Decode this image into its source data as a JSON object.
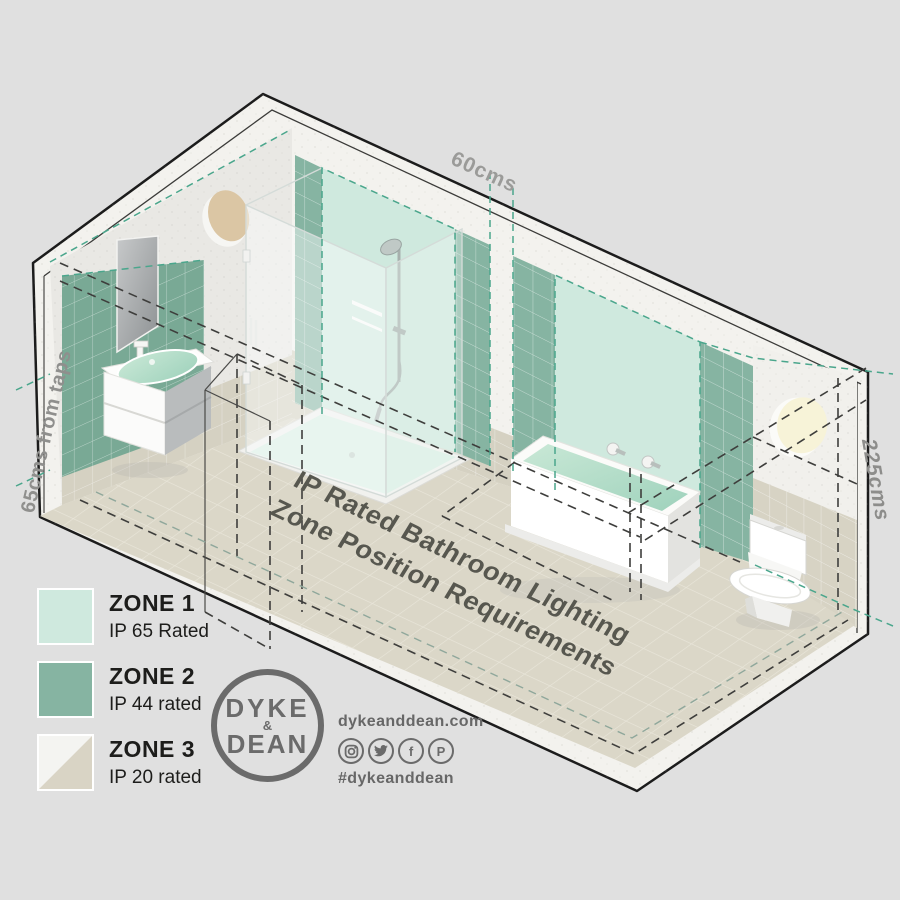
{
  "page": {
    "background": "#e0e0e0"
  },
  "colors": {
    "zone1": "#cfe9de",
    "zone2": "#86b4a2",
    "zone2_shadow": "#79a995",
    "zone3_top": "#f4f4f1",
    "zone3_bottom": "#d9d4c5",
    "teal_dash": "#4aa68c",
    "black_dash": "#3e3e3c",
    "floor": "#dbd7c8",
    "wall_concrete": "#f3f2ee",
    "wall_tile_beige": "#d5d1c2"
  },
  "dimensions": {
    "top": "60cms",
    "left": "65cms from taps",
    "right": "225cms"
  },
  "floor_label": {
    "line1": "IP Rated Bathroom Lighting",
    "line2": "Zone Position Requirements"
  },
  "legend": {
    "items": [
      {
        "zone": "ZONE 1",
        "rating": "IP 65 Rated"
      },
      {
        "zone": "ZONE 2",
        "rating": "IP 44 rated"
      },
      {
        "zone": "ZONE 3",
        "rating": "IP 20 rated"
      }
    ]
  },
  "brand": {
    "logo_top": "DYKE",
    "logo_amp": "&",
    "logo_bottom": "DEAN",
    "website": "dykeanddean.com",
    "hashtag": "#dykeanddean",
    "social_icons": [
      "instagram",
      "twitter",
      "facebook",
      "pinterest"
    ]
  }
}
